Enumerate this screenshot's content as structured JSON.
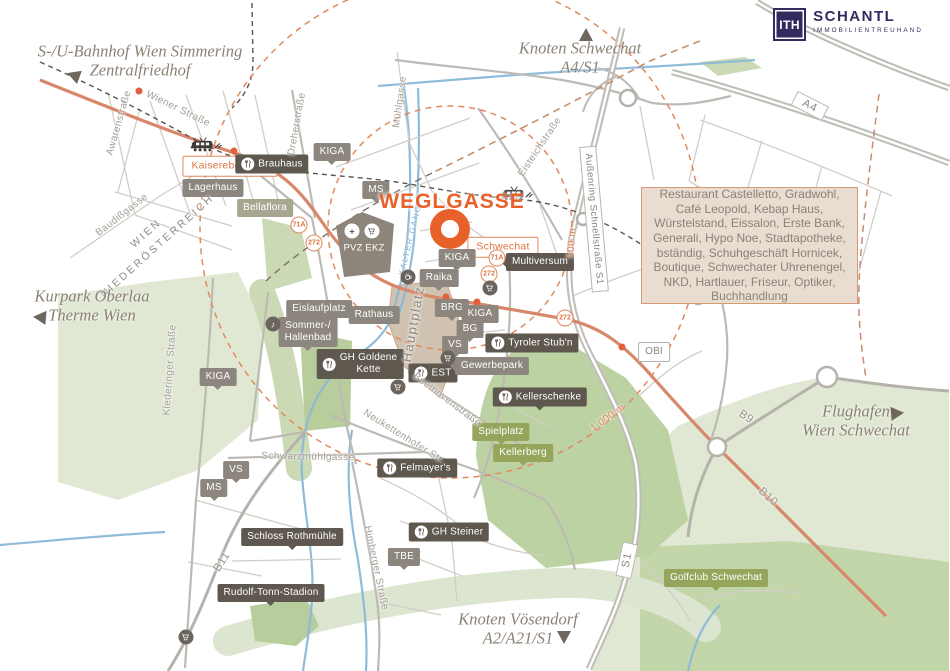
{
  "brand": {
    "logo_mark": "ITH",
    "name": "SCHANTL",
    "subtitle": "IMMOBILIENTREUHAND"
  },
  "title": {
    "text": "WEGLGASSE"
  },
  "info_box": {
    "text": "Restaurant Castelletto, Gradwohl, Café Leopold, Kebap Haus, Würstelstand, Eissalon, Erste Bank, Generali, Hypo Noe, Stadtapotheke, bständig, Schuhgeschäft Hornicek, Boutique, Schwechater Uhrenengel, NKD, Hartlauer, Friseur, Optiker, Buchhandlung"
  },
  "colors": {
    "accent_orange": "#e8612b",
    "road_orange": "#d8886a",
    "river_blue": "#8ab8da",
    "tag_gray": "#8c867e",
    "tag_dark": "#5f584f",
    "tag_green": "#96a55c",
    "logo_navy": "#312b5e",
    "infobox_bg": "#e9ddd2",
    "park_green": "#e0e8d4"
  },
  "directions": [
    {
      "text": "S-/U-Bahnhof Wien Simmering\nZentralfriedhof",
      "x": 140,
      "y": 61,
      "ax": 70,
      "ay": 74,
      "rot": 200
    },
    {
      "text": "Knoten Schwechat\nA4/S1",
      "x": 580,
      "y": 58,
      "ax": 586,
      "ay": 31,
      "rot": -90
    },
    {
      "text": "Kurpark Oberlaa\nTherme Wien",
      "x": 92,
      "y": 306,
      "ax": 36,
      "ay": 317,
      "rot": 185
    },
    {
      "text": "Flughafen\nWien Schwechat",
      "x": 856,
      "y": 421,
      "ax": 901,
      "ay": 413,
      "rot": -5
    },
    {
      "text": "Knoten Vösendorf\nA2/A21/S1",
      "x": 518,
      "y": 629,
      "ax": 564,
      "ay": 641,
      "rot": 90
    }
  ],
  "poi_tags": [
    {
      "text": "Kaiserebersdorf",
      "x": 230,
      "y": 166,
      "style": "outline"
    },
    {
      "text": "Brauhaus",
      "x": 272,
      "y": 164,
      "style": "dark",
      "icon": "fork"
    },
    {
      "text": "Lagerhaus",
      "x": 213,
      "y": 188,
      "style": "gray"
    },
    {
      "text": "Bellaflora",
      "x": 265,
      "y": 208,
      "style": "sage"
    },
    {
      "text": "KIGA",
      "x": 332,
      "y": 152,
      "style": "gray",
      "ptr": "down"
    },
    {
      "text": "MS",
      "x": 376,
      "y": 190,
      "style": "gray",
      "ptr": "down"
    },
    {
      "text": "PVZ EKZ",
      "x": 364,
      "y": 248,
      "style": "plain"
    },
    {
      "text": "Schwechat",
      "x": 503,
      "y": 247,
      "style": "outline"
    },
    {
      "text": "KIGA",
      "x": 457,
      "y": 258,
      "style": "gray",
      "ptr": "down"
    },
    {
      "text": "Raika",
      "x": 439,
      "y": 278,
      "style": "gray",
      "ptr": "down"
    },
    {
      "text": "Multiversum",
      "x": 540,
      "y": 262,
      "style": "dark",
      "ptr": "left"
    },
    {
      "text": "BRG",
      "x": 452,
      "y": 308,
      "style": "gray",
      "ptr": "down"
    },
    {
      "text": "KIGA",
      "x": 480,
      "y": 314,
      "style": "gray",
      "ptr": "down"
    },
    {
      "text": "BG",
      "x": 470,
      "y": 329,
      "style": "gray",
      "ptr": "down"
    },
    {
      "text": "VS",
      "x": 455,
      "y": 345,
      "style": "gray",
      "ptr": "down"
    },
    {
      "text": "Rathaus",
      "x": 374,
      "y": 315,
      "style": "gray"
    },
    {
      "text": "Eislaufplatz",
      "x": 319,
      "y": 309,
      "style": "gray"
    },
    {
      "text": "Sommer-/\nHallenbad",
      "x": 308,
      "y": 332,
      "style": "gray",
      "ptr": "down"
    },
    {
      "text": "GH Goldene\nKette",
      "x": 360,
      "y": 364,
      "style": "dark",
      "icon": "fork"
    },
    {
      "text": "EST",
      "x": 433,
      "y": 373,
      "style": "dark",
      "icon": "fork"
    },
    {
      "text": "Gewerbepark",
      "x": 492,
      "y": 366,
      "style": "gray",
      "ptr": "left"
    },
    {
      "text": "Tyroler Stub'n",
      "x": 532,
      "y": 343,
      "style": "dark",
      "icon": "fork"
    },
    {
      "text": "OBI",
      "x": 654,
      "y": 352,
      "style": "obi"
    },
    {
      "text": "Kellerschenke",
      "x": 540,
      "y": 397,
      "style": "dark",
      "icon": "fork",
      "ptr": "down"
    },
    {
      "text": "Spielplatz",
      "x": 501,
      "y": 432,
      "style": "green",
      "ptr": "down"
    },
    {
      "text": "Kellerberg",
      "x": 523,
      "y": 453,
      "style": "green",
      "ptr": "down"
    },
    {
      "text": "Felmayer's",
      "x": 417,
      "y": 468,
      "style": "dark",
      "icon": "fork"
    },
    {
      "text": "GH Steiner",
      "x": 449,
      "y": 532,
      "style": "dark",
      "icon": "fork"
    },
    {
      "text": "TBE",
      "x": 404,
      "y": 557,
      "style": "gray",
      "ptr": "down"
    },
    {
      "text": "Schloss Rothmühle",
      "x": 292,
      "y": 537,
      "style": "dark",
      "ptr": "down"
    },
    {
      "text": "Rudolf-Tonn-Stadion",
      "x": 271,
      "y": 593,
      "style": "dark",
      "ptr": "down"
    },
    {
      "text": "Golfclub Schwechat",
      "x": 716,
      "y": 578,
      "style": "green",
      "ptr": "down"
    },
    {
      "text": "VS",
      "x": 236,
      "y": 470,
      "style": "gray",
      "ptr": "down"
    },
    {
      "text": "MS",
      "x": 214,
      "y": 488,
      "style": "gray",
      "ptr": "down"
    },
    {
      "text": "KIGA",
      "x": 218,
      "y": 377,
      "style": "gray",
      "ptr": "down"
    }
  ],
  "street_labels": [
    {
      "text": "Wiener Straße",
      "x": 178,
      "y": 109,
      "rot": 26
    },
    {
      "text": "Awarenstraße",
      "x": 119,
      "y": 123,
      "rot": -74
    },
    {
      "text": "Baudißgasse",
      "x": 122,
      "y": 215,
      "rot": -38
    },
    {
      "text": "WIEN\nNIEDERÖSTERREICH",
      "x": 152,
      "y": 240,
      "rot": -42,
      "cls": "border-label"
    },
    {
      "text": "Dreherstraße",
      "x": 297,
      "y": 124,
      "rot": -80
    },
    {
      "text": "Mühlgasse",
      "x": 400,
      "y": 102,
      "rot": -82
    },
    {
      "text": "Eisteichstraße",
      "x": 540,
      "y": 147,
      "rot": -56
    },
    {
      "text": "Außenring Schnellstraße S1",
      "x": 594,
      "y": 219,
      "rot": 85,
      "cls": "road-badge-long"
    },
    {
      "text": "Klederinger Straße",
      "x": 170,
      "y": 370,
      "rot": -86
    },
    {
      "text": "Schwarzmühlgasse",
      "x": 308,
      "y": 457,
      "rot": 1
    },
    {
      "text": "Neukettenhofer Str.",
      "x": 404,
      "y": 437,
      "rot": 32
    },
    {
      "text": "Beethovenstraße",
      "x": 447,
      "y": 400,
      "rot": 37
    },
    {
      "text": "Himberger Straße",
      "x": 376,
      "y": 568,
      "rot": 78
    },
    {
      "text": "Hauptplatz",
      "x": 413,
      "y": 324,
      "rot": -80,
      "cls": "plaza-label"
    },
    {
      "text": "KALTER GANG",
      "x": 410,
      "y": 240,
      "rot": -76,
      "cls": "water-label"
    },
    {
      "text": "B11",
      "x": 222,
      "y": 562,
      "rot": -58,
      "cls": "route-label"
    },
    {
      "text": "B9",
      "x": 746,
      "y": 417,
      "rot": 33,
      "cls": "route-label"
    },
    {
      "text": "B10",
      "x": 768,
      "y": 497,
      "rot": 42,
      "cls": "route-label"
    },
    {
      "text": "A4",
      "x": 810,
      "y": 106,
      "rot": 27,
      "cls": "hw-badge"
    },
    {
      "text": "S1",
      "x": 627,
      "y": 560,
      "rot": -78,
      "cls": "hw-badge"
    },
    {
      "text": "500 m",
      "x": 572,
      "y": 243,
      "rot": -86,
      "cls": "radius-label"
    },
    {
      "text": "1.000 m",
      "x": 608,
      "y": 418,
      "rot": -36,
      "cls": "radius-label"
    }
  ],
  "route_badges": [
    {
      "text": "71A",
      "x": 299,
      "y": 225
    },
    {
      "text": "272",
      "x": 314,
      "y": 243
    },
    {
      "text": "71A",
      "x": 497,
      "y": 258
    },
    {
      "text": "272",
      "x": 489,
      "y": 274
    },
    {
      "text": "272",
      "x": 565,
      "y": 318
    }
  ],
  "poi_icons": [
    {
      "icon": "cart",
      "x": 490,
      "y": 288,
      "style": "dark"
    },
    {
      "icon": "cart",
      "x": 448,
      "y": 358,
      "style": "dark"
    },
    {
      "icon": "cart",
      "x": 398,
      "y": 387,
      "style": "dark"
    },
    {
      "icon": "cart",
      "x": 186,
      "y": 637,
      "style": "dark"
    },
    {
      "icon": "cup",
      "x": 408,
      "y": 277,
      "style": "dark"
    },
    {
      "icon": "music",
      "x": 273,
      "y": 324,
      "style": "dark"
    },
    {
      "icon": "plus",
      "x": 352,
      "y": 231,
      "style": "light"
    },
    {
      "icon": "cart",
      "x": 372,
      "y": 231,
      "style": "light"
    }
  ],
  "trains": [
    {
      "x": 205,
      "y": 146
    },
    {
      "x": 516,
      "y": 195
    }
  ]
}
